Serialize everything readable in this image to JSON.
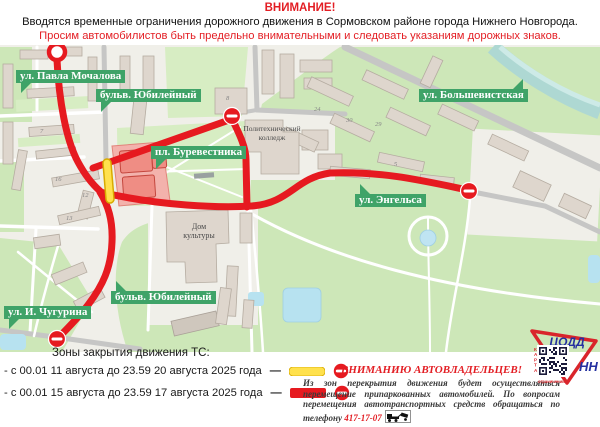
{
  "header": {
    "attention": "ВНИМАНИЕ!",
    "line2": "Вводятся временные ограничения дорожного движения в Сормовском районе города Нижнего Новгорода.",
    "line3": "Просим автомобилистов быть предельно внимательными и следовать указаниям дорожных знаков."
  },
  "map": {
    "labels": {
      "pavla_mochalova": "ул. Павла Мочалова",
      "yubileyny_top": "бульв. Юбилейный",
      "bolshevistskaya": "ул. Большевистская",
      "burevestnika": "пл. Буревестника",
      "engelsa": "ул. Энгельса",
      "chugurina": "ул. И. Чугурина",
      "yubileyny_bottom": "бульв. Юбилейный"
    },
    "poi": {
      "college1": "Политехнический",
      "college2": "колледж",
      "dk1": "Дом",
      "dk2": "культуры"
    },
    "numbers": {
      "n7": "7",
      "n8": "8",
      "n16": "16",
      "n12": "12",
      "n13": "13",
      "n24": "24",
      "n30": "30",
      "n29": "29",
      "n5": "5"
    }
  },
  "legend": {
    "title": "Зоны закрытия движения ТС:",
    "dash": "—",
    "items": [
      {
        "text": "- с 00.01 11 августа до 23.59 20 августа 2025 года",
        "color": "#ffe14d"
      },
      {
        "text": "- с 00.01 15 августа до 23.59 17 августа 2025 года",
        "color": "#e61a20"
      }
    ]
  },
  "notice": {
    "title": "ВНИМАНИЮ АВТОВЛАДЕЛЬЦЕВ!",
    "body": "Из зон перекрытия движения будет осуществляться перемещение припаркованных автомобилей.  По вопросам перемещения автотранспортных средств обращаться по телефону ",
    "phone": "417-17-07"
  },
  "logo": {
    "org": "ЦОДД",
    "city": "НН",
    "qr_side": "КАРТА",
    "qr_bottom": "ограничений"
  },
  "colors": {
    "closure_red": "#e61a20",
    "closure_yellow": "#ffe14d",
    "label_green": "#3fa368"
  }
}
